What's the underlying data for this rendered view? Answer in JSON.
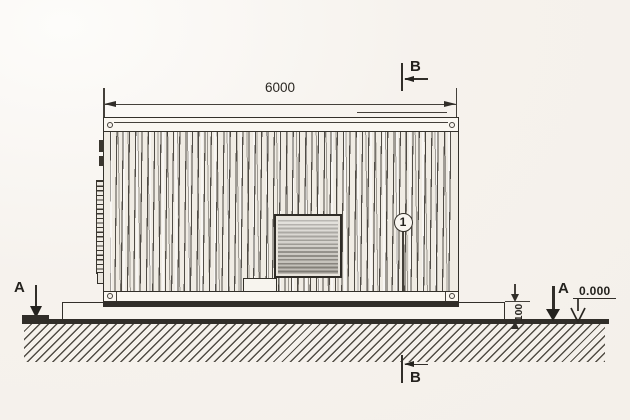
{
  "labels": {
    "width_dimension": "6000",
    "plinth_height_dimension": "100",
    "ground_elevation": "0.000",
    "callout_1": "1",
    "section_a": "A",
    "section_b": "B"
  },
  "colors": {
    "background": "#f5f1ec",
    "line": "#312e29",
    "grille_dark": "#8a867e",
    "grille_light": "#d5d1c9"
  }
}
